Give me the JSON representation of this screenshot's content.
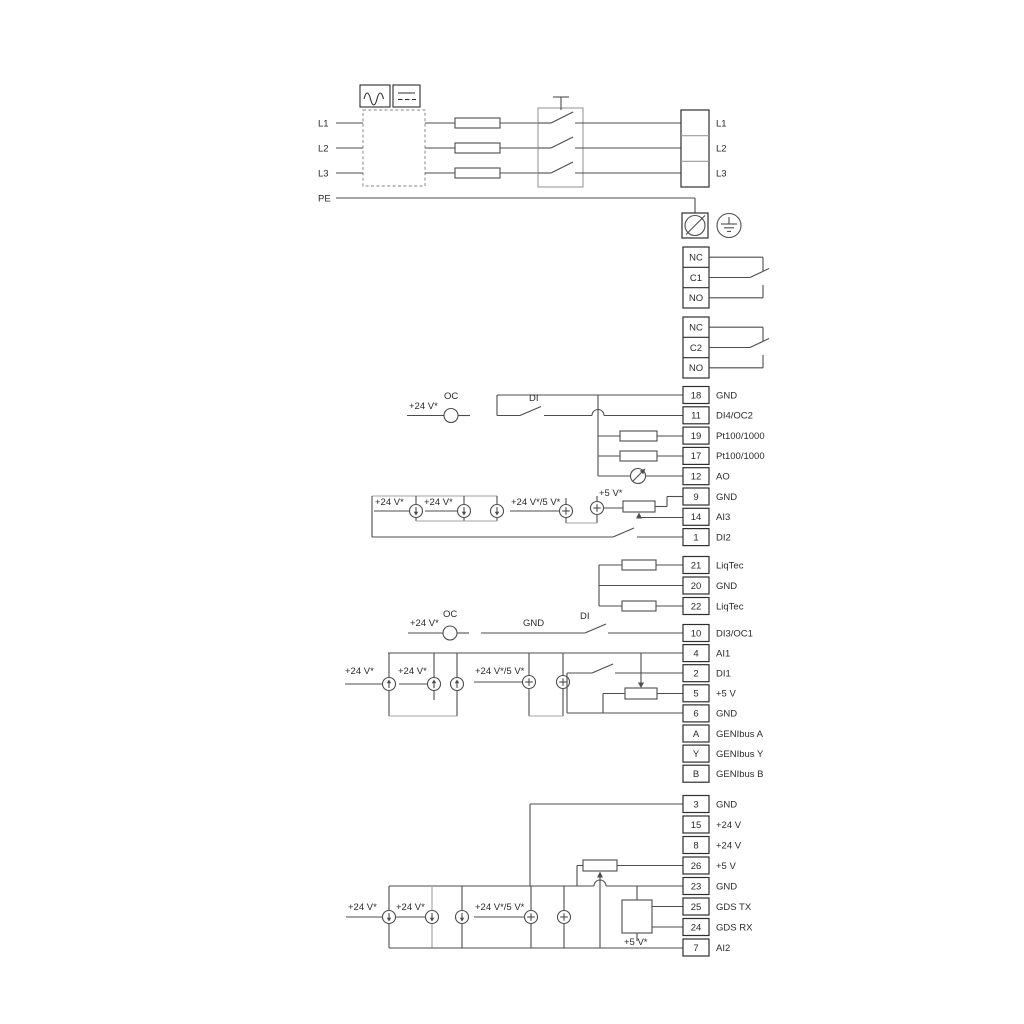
{
  "diagram": {
    "title_hint": "pump drive wiring diagram",
    "colors": {
      "wire": "#4d4d4d",
      "bracket": "#a3a3a3",
      "box_stroke": "#2e2e2e",
      "text": "#2b2b2b",
      "background": "#ffffff"
    },
    "mains_in": [
      "L1",
      "L2",
      "L3",
      "PE"
    ],
    "mains_out": [
      "L1",
      "L2",
      "L3"
    ],
    "relay1": {
      "labels": [
        "NC",
        "C1",
        "NO"
      ]
    },
    "relay2": {
      "labels": [
        "NC",
        "C2",
        "NO"
      ]
    },
    "io_top": {
      "terminals": [
        {
          "num": "18",
          "label": "GND"
        },
        {
          "num": "11",
          "label": "DI4/OC2"
        },
        {
          "num": "19",
          "label": "Pt100/1000"
        },
        {
          "num": "17",
          "label": "Pt100/1000"
        },
        {
          "num": "12",
          "label": "AO"
        },
        {
          "num": "9",
          "label": "GND"
        },
        {
          "num": "14",
          "label": "AI3"
        },
        {
          "num": "1",
          "label": "DI2"
        }
      ]
    },
    "liqtec": {
      "terminals": [
        {
          "num": "21",
          "label": "LiqTec"
        },
        {
          "num": "20",
          "label": "GND"
        },
        {
          "num": "22",
          "label": "LiqTec"
        }
      ]
    },
    "io_mid": {
      "terminals": [
        {
          "num": "10",
          "label": "DI3/OC1"
        },
        {
          "num": "4",
          "label": "AI1"
        },
        {
          "num": "2",
          "label": "DI1"
        },
        {
          "num": "5",
          "label": "+5 V"
        },
        {
          "num": "6",
          "label": "GND"
        },
        {
          "num": "A",
          "label": "GENIbus A"
        },
        {
          "num": "Y",
          "label": "GENIbus Y"
        },
        {
          "num": "B",
          "label": "GENIbus B"
        }
      ]
    },
    "io_bottom": {
      "terminals": [
        {
          "num": "3",
          "label": "GND"
        },
        {
          "num": "15",
          "label": "+24 V"
        },
        {
          "num": "8",
          "label": "+24 V"
        },
        {
          "num": "26",
          "label": "+5 V"
        },
        {
          "num": "23",
          "label": "GND"
        },
        {
          "num": "25",
          "label": "GDS TX"
        },
        {
          "num": "24",
          "label": "GDS RX"
        },
        {
          "num": "7",
          "label": "AI2"
        }
      ]
    },
    "ann": {
      "v24": "+24 V*",
      "v24_5": "+24 V*/5 V*",
      "v5": "+5 V*",
      "oc": "OC",
      "di": "DI",
      "gnd": "GND"
    }
  }
}
